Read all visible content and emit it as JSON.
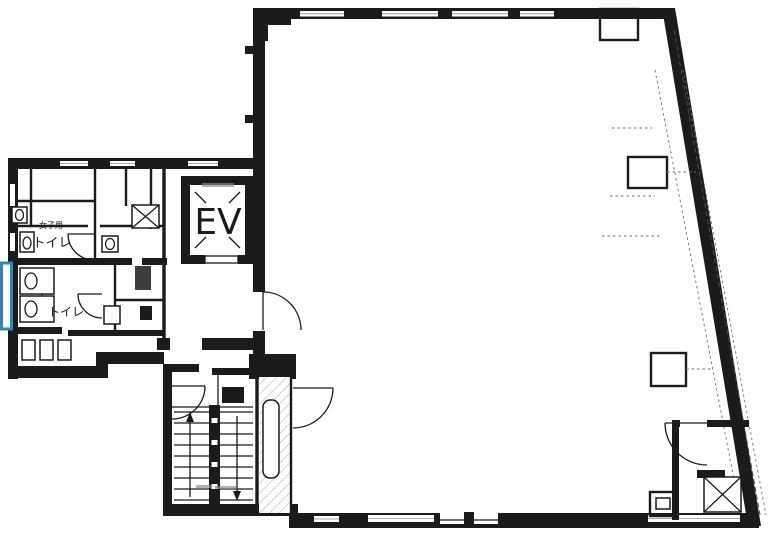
{
  "floor_plan": {
    "labels": {
      "elevator": "EV",
      "toilet_upper_sub": "女子用",
      "toilet_upper": "トイレ",
      "toilet_lower": "トイレ"
    },
    "colors": {
      "ink": "#1b1b1b",
      "highlight": "#2e86c1",
      "paper": "#ffffff"
    }
  }
}
